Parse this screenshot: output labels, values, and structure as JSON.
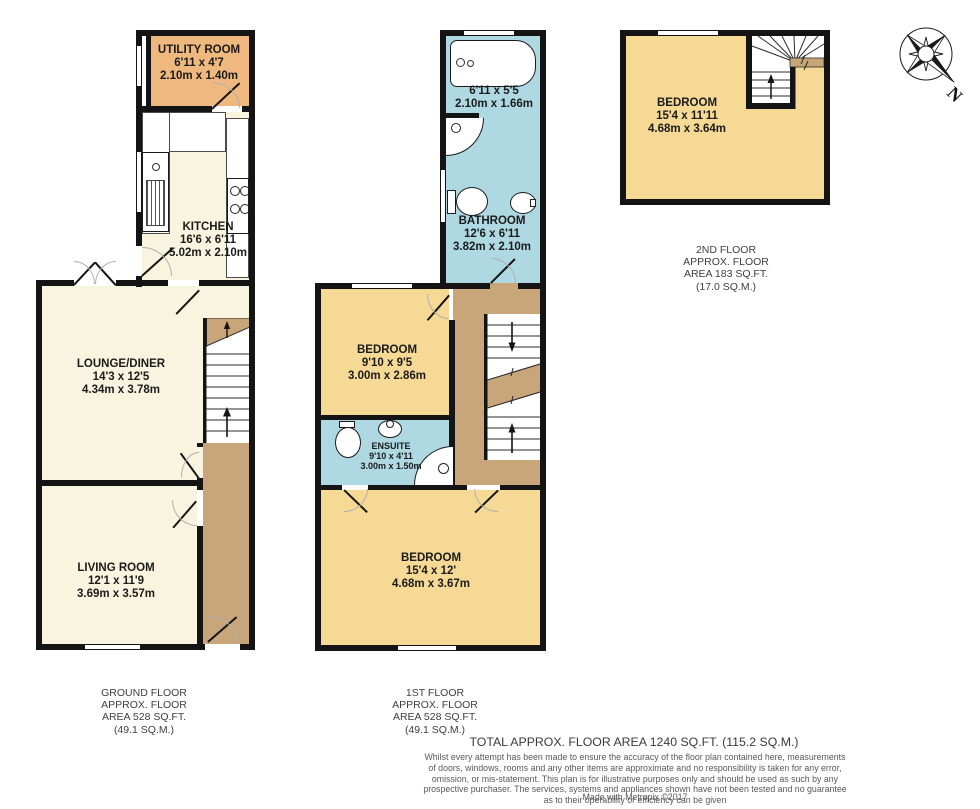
{
  "compass": {
    "label": "N"
  },
  "floors": {
    "ground": {
      "caption": [
        "GROUND FLOOR",
        "APPROX. FLOOR",
        "AREA 528 SQ.FT.",
        "(49.1 SQ.M.)"
      ],
      "rooms": {
        "utility": {
          "name": "UTILITY ROOM",
          "imperial": "6'11 x 4'7",
          "metric": "2.10m x 1.40m"
        },
        "kitchen": {
          "name": "KITCHEN",
          "imperial": "16'6 x 6'11",
          "metric": "5.02m x 2.10m"
        },
        "lounge_diner": {
          "name": "LOUNGE/DINER",
          "imperial": "14'3 x 12'5",
          "metric": "4.34m x 3.78m"
        },
        "living_room": {
          "name": "LIVING ROOM",
          "imperial": "12'1 x 11'9",
          "metric": "3.69m x 3.57m"
        }
      }
    },
    "first": {
      "caption": [
        "1ST FLOOR",
        "APPROX. FLOOR",
        "AREA 528 SQ.FT.",
        "(49.1 SQ.M.)"
      ],
      "rooms": {
        "bath_area": {
          "imperial": "6'11 x 5'5",
          "metric": "2.10m x 1.66m"
        },
        "bathroom": {
          "name": "BATHROOM",
          "imperial": "12'6 x 6'11",
          "metric": "3.82m x 2.10m"
        },
        "bedroom_small": {
          "name": "BEDROOM",
          "imperial": "9'10 x 9'5",
          "metric": "3.00m x 2.86m"
        },
        "ensuite": {
          "name": "ENSUITE",
          "imperial": "9'10 x 4'11",
          "metric": "3.00m x 1.50m"
        },
        "bedroom_large": {
          "name": "BEDROOM",
          "imperial": "15'4 x 12'",
          "metric": "4.68m x 3.67m"
        }
      }
    },
    "second": {
      "caption": [
        "2ND FLOOR",
        "APPROX. FLOOR",
        "AREA 183 SQ.FT.",
        "(17.0 SQ.M.)"
      ],
      "rooms": {
        "bedroom": {
          "name": "BEDROOM",
          "imperial": "15'4 x 11'11",
          "metric": "4.68m x 3.64m"
        }
      }
    }
  },
  "footer": {
    "total": "TOTAL APPROX. FLOOR AREA 1240 SQ.FT. (115.2 SQ.M.)",
    "disclaimer": "Whilst every attempt has been made to ensure the accuracy of the floor plan contained here, measurements of doors, windows, rooms and any other items are approximate and no responsibility is taken for any error, omission, or mis-statement. This plan is for illustrative purposes only and should be used as such by any prospective purchaser. The services, systems and appliances shown have not been tested and no guarantee as to their operability or efficiency can be given",
    "credit": "Made with Metropix ©2017"
  },
  "colors": {
    "wall": "#141414",
    "room_cream": "#f9f4df",
    "utility_tan": "#efb87e",
    "hall_tan": "#c8a67a",
    "bathroom_blue": "#aed9e3",
    "bedroom_yellow": "#f5d995"
  }
}
